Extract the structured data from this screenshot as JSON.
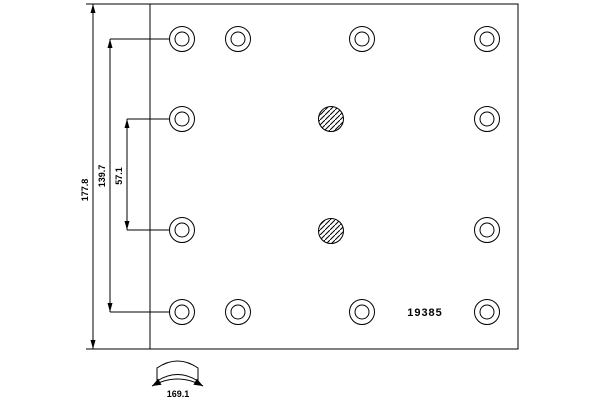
{
  "drawing": {
    "part_number": "19385",
    "labels": {
      "overall_height": "177.8",
      "rivet_span": "139.7",
      "rivet_pitch": "57.1",
      "arc_width": "169.1"
    },
    "line_color": "#000000",
    "background_color": "#ffffff",
    "geometry": {
      "plate": {
        "x": 150,
        "y": 4,
        "width": 368,
        "height": 345
      },
      "rivet_holes": {
        "outer_radius": 12.5,
        "inner_radius": 7,
        "centers": [
          [
            182,
            39
          ],
          [
            238,
            39
          ],
          [
            362,
            39
          ],
          [
            487,
            39
          ],
          [
            182,
            119
          ],
          [
            487,
            119
          ],
          [
            182,
            230
          ],
          [
            487,
            230
          ],
          [
            182,
            312
          ],
          [
            238,
            312
          ],
          [
            362,
            312
          ],
          [
            487,
            312
          ]
        ]
      },
      "hatched_holes": {
        "radius": 12.5,
        "centers": [
          [
            331,
            119
          ],
          [
            331,
            231
          ]
        ]
      }
    }
  }
}
